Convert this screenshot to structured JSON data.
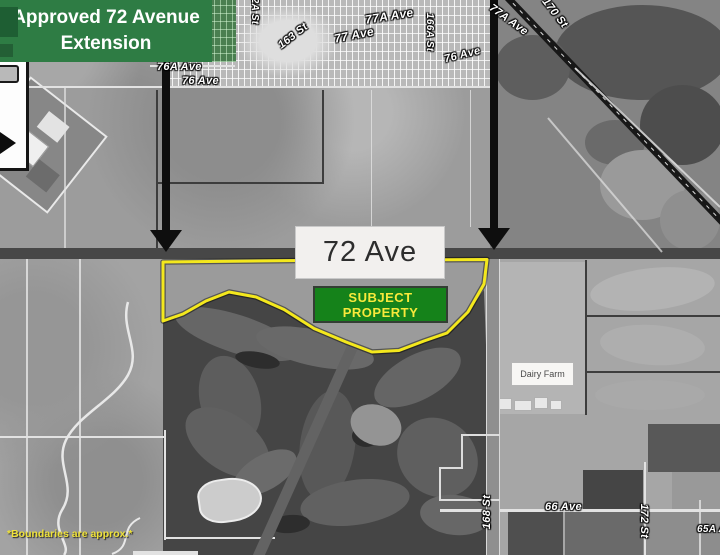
{
  "banner": {
    "text": "Approved 72 Avenue Extension"
  },
  "note": {
    "text": "*Boundaries are approx.*"
  },
  "road_box": {
    "label": "72 Ave"
  },
  "subject_property": {
    "line1": "SUBJECT",
    "line2": "PROPERTY"
  },
  "dairy_farm": {
    "label": "Dairy Farm"
  },
  "street_labels": {
    "l76a": "76A Ave",
    "l76": "76 Ave",
    "s162a": "162A St",
    "s163": "163 St",
    "l77a": "77A Ave",
    "l77": "77 Ave",
    "s166a": "166A St",
    "r76": "76 Ave",
    "tr77a": "77A Ave",
    "s170": "170 St",
    "s168": "168 St",
    "l66": "66 Ave",
    "s172": "172 St",
    "l65a": "65A Ave"
  },
  "colors": {
    "banner_green": "#2e7c44",
    "subject_green": "#15821a",
    "highlight_yellow": "#f4e81d",
    "label_yellow": "#f8e93b",
    "road_dark": "#474747",
    "arrow_black": "#0e0e0e"
  }
}
